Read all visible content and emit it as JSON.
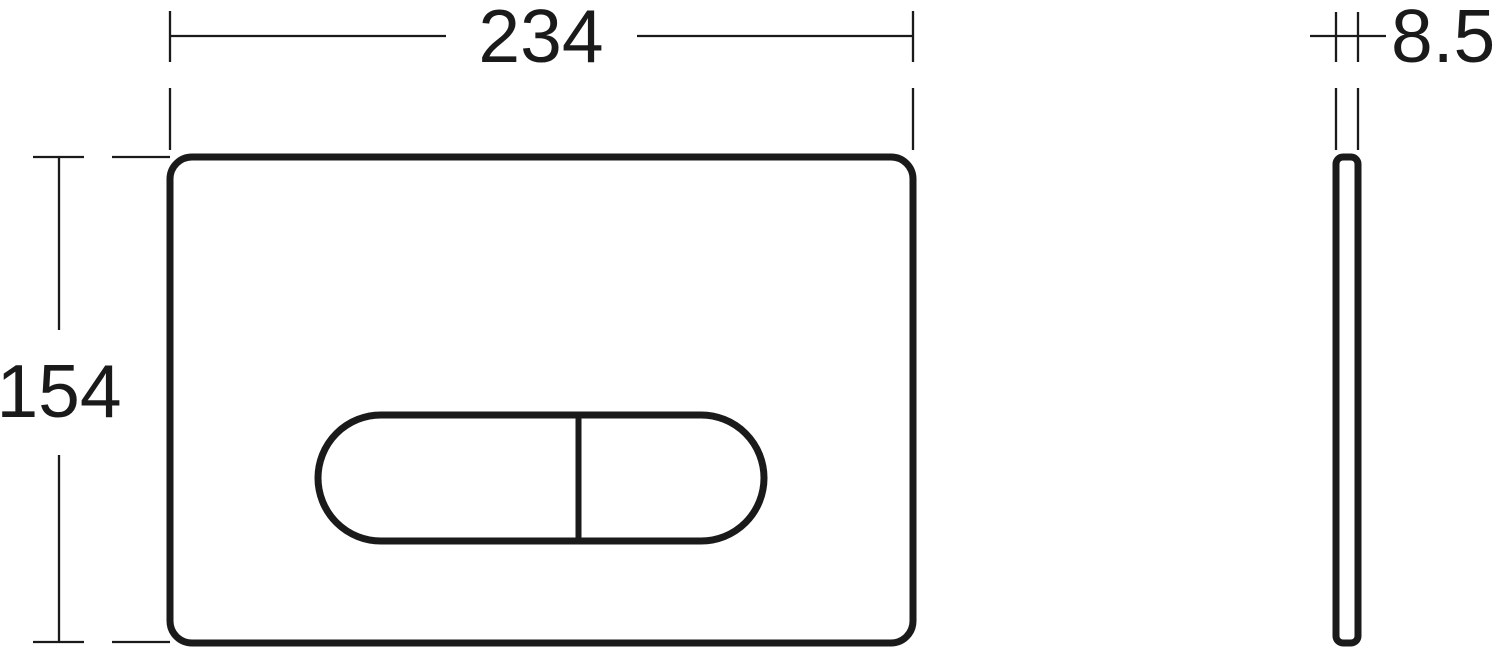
{
  "drawing": {
    "background_color": "#ffffff",
    "line_color": "#1a1a1a",
    "dimensions": {
      "width": "234",
      "height": "154",
      "depth": "8.5"
    }
  }
}
